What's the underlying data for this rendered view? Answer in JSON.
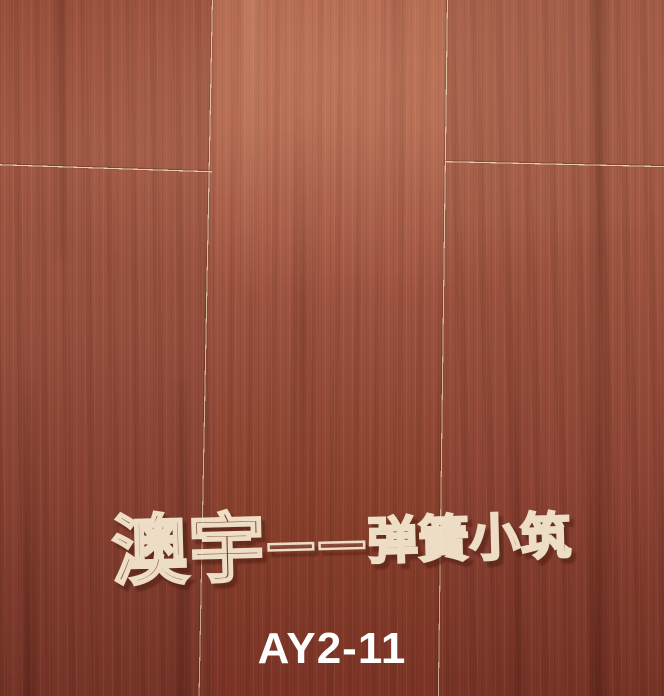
{
  "photo": {
    "watermark": {
      "brand": "澳宇",
      "rest": "——弹簧小筑",
      "full_text": "澳宇——弹簧小筑"
    },
    "label": {
      "product_code": "AY2-11"
    },
    "colors": {
      "wood_base": "#99503d",
      "wood_light": "#ad624b",
      "wood_dark": "#7e3829",
      "plank_seam": "#e6d5b6",
      "watermark_outline": "#f1e4ca",
      "label_text": "#ffffff"
    }
  }
}
